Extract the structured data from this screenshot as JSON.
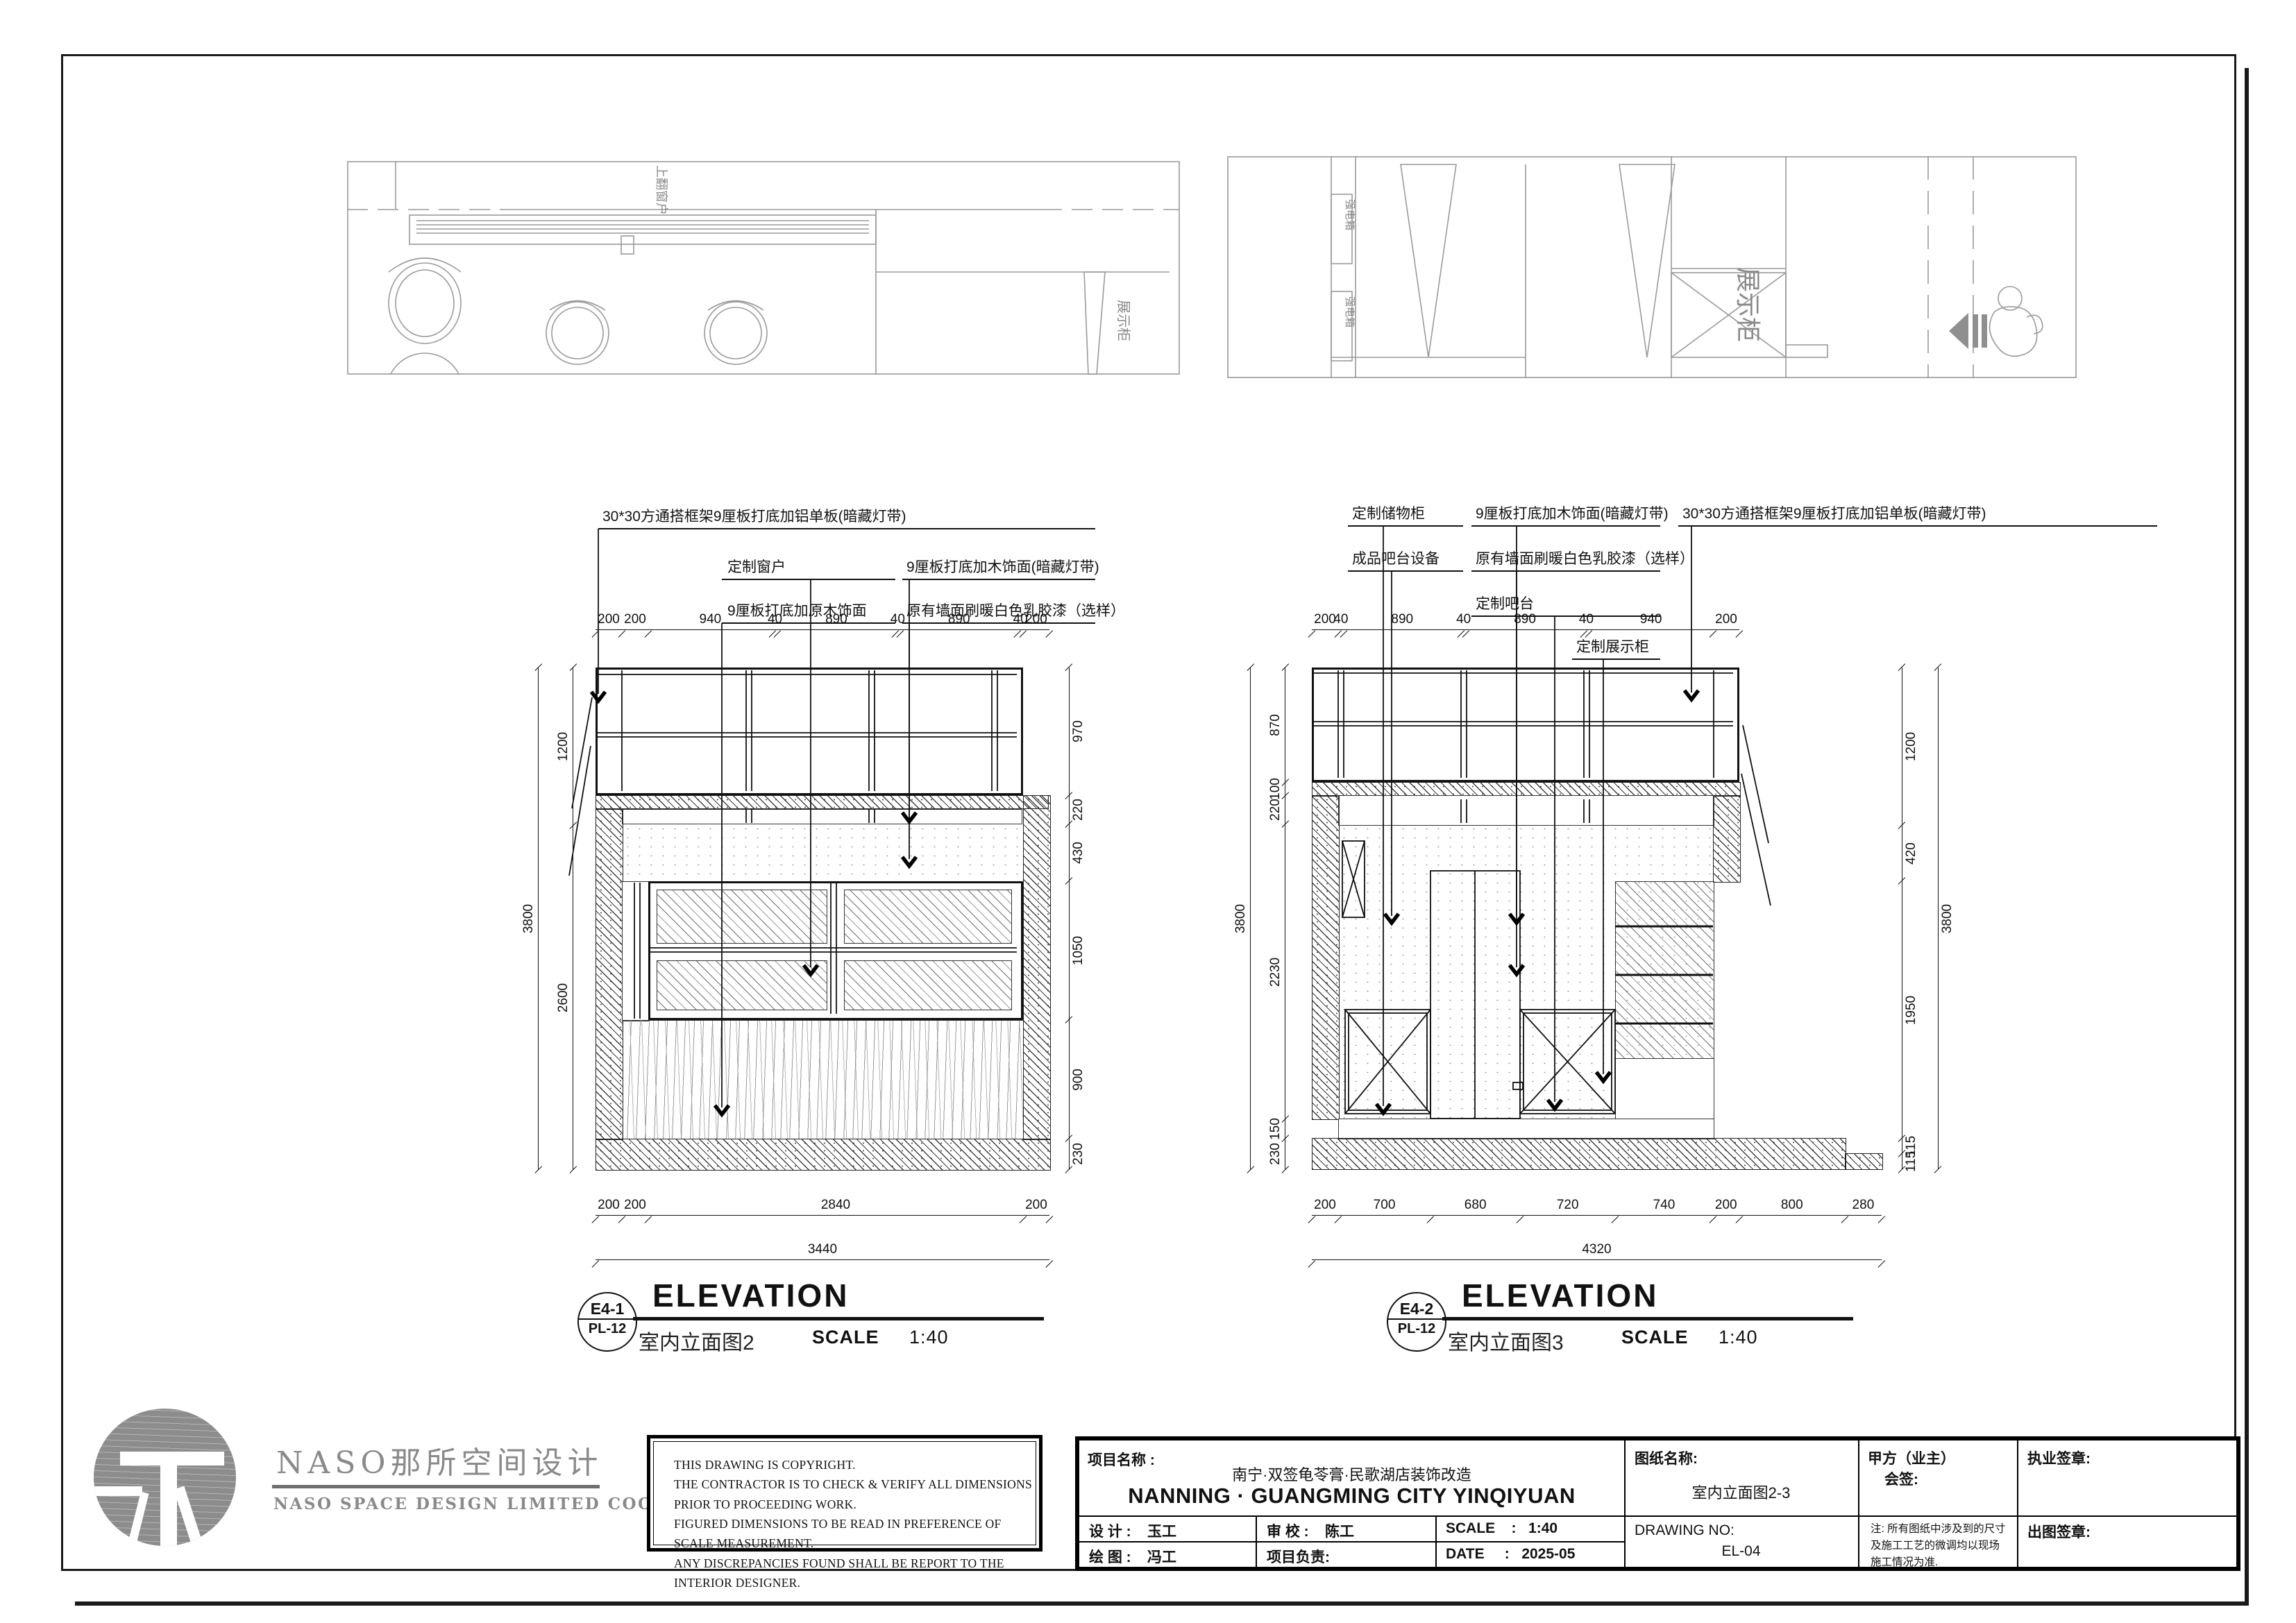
{
  "plans": {
    "left": {
      "window_label": "上翻窗户",
      "display_label": "展示柜"
    },
    "right": {
      "power_box_label_1": "强电箱",
      "power_box_label_2": "强电箱",
      "display_cabinet_label": "展示柜"
    }
  },
  "elev_left": {
    "callouts": {
      "c1": "30*30方通搭框架9厘板打底加铝单板(暗藏灯带)",
      "c2": "定制窗户",
      "c3": "9厘板打底加原木饰面",
      "c4": "9厘板打底加木饰面(暗藏灯带)",
      "c5": "原有墙面刷暖白色乳胶漆（选样）"
    },
    "dims_top": [
      200,
      200,
      940,
      40,
      890,
      40,
      890,
      40,
      200
    ],
    "dims_bottom": [
      200,
      200,
      2840,
      200
    ],
    "total_bottom": [
      3440
    ],
    "dims_left": [
      1200,
      2600
    ],
    "total_left": [
      3800
    ],
    "dims_right": [
      970,
      220,
      430,
      1050,
      900,
      230
    ],
    "title": {
      "tag": "E4-1",
      "ref": "PL-12",
      "name": "ELEVATION",
      "cn": "室内立面图2",
      "scale_label": "SCALE",
      "scale": "1:40"
    }
  },
  "elev_right": {
    "callouts": {
      "c1": "定制储物柜",
      "c2": "成品吧台设备",
      "c3": "9厘板打底加木饰面(暗藏灯带)",
      "c4": "原有墙面刷暖白色乳胶漆（选样）",
      "c5": "定制吧台",
      "c6": "定制展示柜",
      "c7": "30*30方通搭框架9厘板打底加铝单板(暗藏灯带)"
    },
    "dims_top": [
      200,
      40,
      890,
      40,
      890,
      40,
      940,
      200
    ],
    "dims_bottom": [
      200,
      700,
      680,
      720,
      740,
      200,
      800,
      280
    ],
    "total_bottom": [
      4320
    ],
    "dims_left": [
      870,
      100,
      220,
      2230,
      150,
      230
    ],
    "total_left": [
      3800
    ],
    "dims_right": [
      1200,
      420,
      1950,
      115,
      115
    ],
    "total_right": [
      3800
    ],
    "title": {
      "tag": "E4-2",
      "ref": "PL-12",
      "name": "ELEVATION",
      "cn": "室内立面图3",
      "scale_label": "SCALE",
      "scale": "1:40"
    }
  },
  "logo": {
    "cn": "NASO那所空间设计",
    "en": "NASO  SPACE  DESIGN  LIMITED  COOMPANY"
  },
  "copyright": {
    "l1": "THIS DRAWING IS COPYRIGHT.",
    "l2": "THE CONTRACTOR IS TO CHECK & VERIFY ALL DIMENSIONS PRIOR TO PROCEEDING WORK.",
    "l3": "FIGURED DIMENSIONS TO BE READ IN PREFERENCE OF SCALE MEASUREMENT.",
    "l4": "ANY DISCREPANCIES FOUND SHALL BE REPORT TO THE INTERIOR DESIGNER."
  },
  "title_block": {
    "project_label": "项目名称    :",
    "project_cn": "南宁·双签龟苓膏·民歌湖店装饰改造",
    "project_en": "NANNING · GUANGMING CITY YINQIYUAN",
    "design_label": "设  计  :",
    "design_value": "玉工",
    "check_label": "审  校  :",
    "check_value": "陈工",
    "scale_label": "SCALE",
    "scale_colon": ":",
    "scale_value": "1:40",
    "draw_label": "绘  图  :",
    "draw_value": "冯工",
    "lead_label": "项目负责:",
    "date_label": "DATE",
    "date_colon": ":",
    "date_value": "2025-05",
    "sheet_name_label": "图纸名称:",
    "sheet_name": "室内立面图2-3",
    "drawing_no_label": "DRAWING NO:",
    "drawing_no": "EL-04",
    "client_label": "甲方（业主）",
    "client_sub": "会签:",
    "note": "注: 所有图纸中涉及到的尺寸及施工工艺的微调均以现场施工情况为准.",
    "license_label": "执业签章:",
    "issue_label": "出图签章:"
  }
}
